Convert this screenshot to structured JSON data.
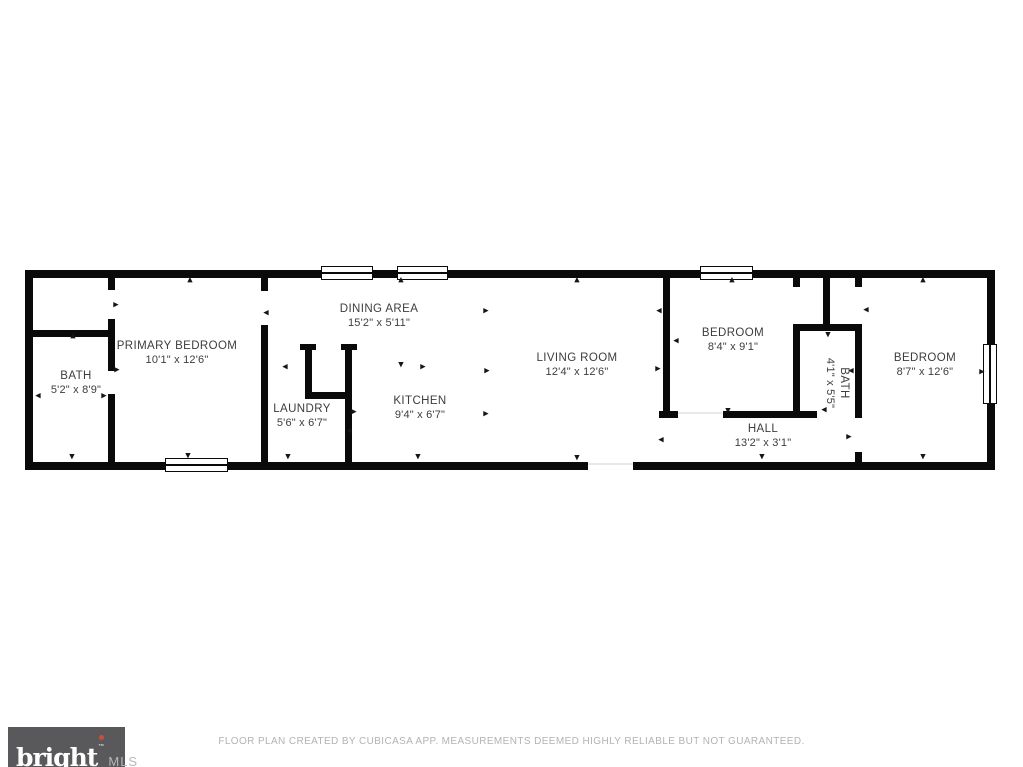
{
  "colors": {
    "background": "#ffffff",
    "wall": "#0a0a0a",
    "label": "#3d3d3d",
    "logo_bg": "#59595b",
    "logo_red": "#c94f38",
    "muted_text": "#b3b3b3"
  },
  "plan": {
    "rooms": [
      {
        "name": "BATH",
        "dims": "5'2\" x 8'9\"",
        "cx": 76,
        "cy": 383,
        "rotated": false
      },
      {
        "name": "PRIMARY BEDROOM",
        "dims": "10'1\" x 12'6\"",
        "cx": 177,
        "cy": 353,
        "rotated": false
      },
      {
        "name": "LAUNDRY",
        "dims": "5'6\" x 6'7\"",
        "cx": 302,
        "cy": 416,
        "rotated": false
      },
      {
        "name": "DINING AREA",
        "dims": "15'2\" x 5'11\"",
        "cx": 379,
        "cy": 316,
        "rotated": false
      },
      {
        "name": "KITCHEN",
        "dims": "9'4\" x 6'7\"",
        "cx": 420,
        "cy": 408,
        "rotated": false
      },
      {
        "name": "LIVING ROOM",
        "dims": "12'4\" x 12'6\"",
        "cx": 577,
        "cy": 365,
        "rotated": false
      },
      {
        "name": "BEDROOM",
        "dims": "8'4\" x 9'1\"",
        "cx": 733,
        "cy": 340,
        "rotated": false
      },
      {
        "name": "BATH",
        "dims": "4'1\" x 5'5\"",
        "cx": 837,
        "cy": 383,
        "rotated": true
      },
      {
        "name": "HALL",
        "dims": "13'2\" x 3'1\"",
        "cx": 763,
        "cy": 436,
        "rotated": false
      },
      {
        "name": "BEDROOM",
        "dims": "8'7\" x 12'6\"",
        "cx": 925,
        "cy": 365,
        "rotated": false
      }
    ],
    "walls": [
      [
        25,
        270,
        970,
        8
      ],
      [
        25,
        462,
        563,
        8
      ],
      [
        633,
        462,
        362,
        8
      ],
      [
        25,
        270,
        8,
        200
      ],
      [
        987,
        270,
        8,
        200
      ],
      [
        30,
        330,
        82,
        7
      ],
      [
        108,
        277,
        7,
        13
      ],
      [
        108,
        319,
        7,
        52
      ],
      [
        108,
        394,
        7,
        72
      ],
      [
        261,
        277,
        7,
        14
      ],
      [
        261,
        325,
        7,
        141
      ],
      [
        300,
        344,
        16,
        6
      ],
      [
        305,
        344,
        7,
        54
      ],
      [
        341,
        344,
        16,
        6
      ],
      [
        345,
        344,
        7,
        122
      ],
      [
        305,
        392,
        47,
        7
      ],
      [
        663,
        277,
        7,
        139
      ],
      [
        659,
        411,
        19,
        7
      ],
      [
        723,
        411,
        94,
        7
      ],
      [
        823,
        277,
        7,
        54
      ],
      [
        793,
        324,
        65,
        7
      ],
      [
        793,
        277,
        7,
        10
      ],
      [
        793,
        324,
        7,
        92
      ],
      [
        855,
        277,
        7,
        10
      ],
      [
        855,
        324,
        7,
        94
      ],
      [
        855,
        452,
        7,
        13
      ]
    ],
    "windows": [
      {
        "x": 321,
        "y": 266,
        "w": 52,
        "h": 14,
        "o": "h"
      },
      {
        "x": 397,
        "y": 266,
        "w": 51,
        "h": 14,
        "o": "h"
      },
      {
        "x": 700,
        "y": 266,
        "w": 53,
        "h": 14,
        "o": "h"
      },
      {
        "x": 165,
        "y": 458,
        "w": 63,
        "h": 14,
        "o": "h"
      },
      {
        "x": 983,
        "y": 344,
        "w": 14,
        "h": 60,
        "o": "v"
      }
    ],
    "door_thresholds": [
      {
        "x": 678,
        "y": 412,
        "w": 44,
        "h": 2
      },
      {
        "x": 588,
        "y": 463,
        "w": 45,
        "h": 2
      }
    ],
    "ticks": [
      {
        "x": 190,
        "y": 280,
        "d": "up"
      },
      {
        "x": 401,
        "y": 280,
        "d": "up"
      },
      {
        "x": 577,
        "y": 280,
        "d": "up"
      },
      {
        "x": 732,
        "y": 280,
        "d": "up"
      },
      {
        "x": 923,
        "y": 280,
        "d": "up"
      },
      {
        "x": 72,
        "y": 457,
        "d": "down"
      },
      {
        "x": 188,
        "y": 456,
        "d": "down"
      },
      {
        "x": 288,
        "y": 457,
        "d": "down"
      },
      {
        "x": 418,
        "y": 457,
        "d": "down"
      },
      {
        "x": 577,
        "y": 458,
        "d": "down"
      },
      {
        "x": 762,
        "y": 457,
        "d": "down"
      },
      {
        "x": 923,
        "y": 457,
        "d": "down"
      },
      {
        "x": 73,
        "y": 336,
        "d": "up"
      },
      {
        "x": 116,
        "y": 305,
        "d": "right"
      },
      {
        "x": 117,
        "y": 370,
        "d": "right"
      },
      {
        "x": 38,
        "y": 396,
        "d": "left"
      },
      {
        "x": 104,
        "y": 396,
        "d": "right"
      },
      {
        "x": 266,
        "y": 313,
        "d": "left"
      },
      {
        "x": 285,
        "y": 367,
        "d": "left"
      },
      {
        "x": 354,
        "y": 412,
        "d": "right"
      },
      {
        "x": 349,
        "y": 431,
        "d": "left"
      },
      {
        "x": 486,
        "y": 311,
        "d": "right"
      },
      {
        "x": 401,
        "y": 365,
        "d": "down"
      },
      {
        "x": 423,
        "y": 367,
        "d": "right"
      },
      {
        "x": 487,
        "y": 371,
        "d": "right"
      },
      {
        "x": 486,
        "y": 414,
        "d": "right"
      },
      {
        "x": 659,
        "y": 311,
        "d": "left"
      },
      {
        "x": 658,
        "y": 369,
        "d": "right"
      },
      {
        "x": 676,
        "y": 341,
        "d": "left"
      },
      {
        "x": 728,
        "y": 411,
        "d": "down"
      },
      {
        "x": 828,
        "y": 335,
        "d": "down"
      },
      {
        "x": 851,
        "y": 371,
        "d": "left"
      },
      {
        "x": 824,
        "y": 410,
        "d": "left"
      },
      {
        "x": 661,
        "y": 440,
        "d": "left"
      },
      {
        "x": 849,
        "y": 437,
        "d": "right"
      },
      {
        "x": 982,
        "y": 372,
        "d": "right"
      },
      {
        "x": 866,
        "y": 310,
        "d": "left"
      }
    ]
  },
  "footer": {
    "logo_text": "bright",
    "logo_tm": "™",
    "logo_mls": "MLS",
    "disclaimer": "FLOOR PLAN CREATED BY CUBICASA APP. MEASUREMENTS DEEMED HIGHLY RELIABLE BUT NOT GUARANTEED."
  }
}
